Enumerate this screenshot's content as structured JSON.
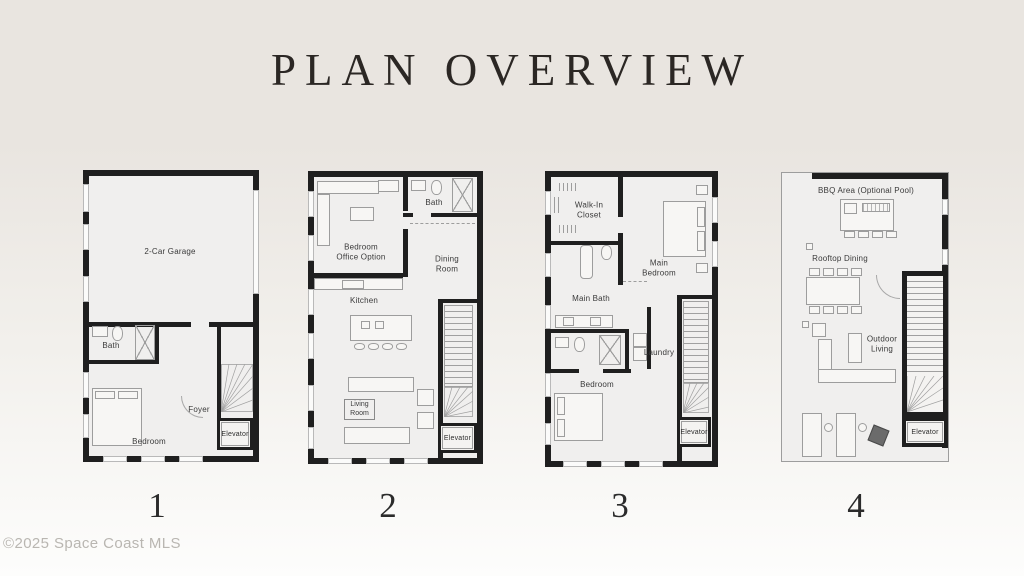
{
  "title": "PLAN OVERVIEW",
  "copyright": "©2025 Space Coast MLS",
  "colors": {
    "background_top": "#e9e5e0",
    "background_bottom": "#fdfdfc",
    "wall": "#1f1f1f",
    "floor": "#f0efee",
    "furniture_line": "#9d9d9d",
    "label_text": "#3a3a3a",
    "title_text": "#2b2724",
    "muted_text": "#b9b6b1"
  },
  "plans": [
    {
      "number": "1",
      "labels": {
        "garage": "2-Car Garage",
        "bath": "Bath",
        "bedroom": "Bedroom",
        "foyer": "Foyer",
        "elevator": "Elevator"
      }
    },
    {
      "number": "2",
      "labels": {
        "bedroom_office": "Bedroom\nOffice Option",
        "bath": "Bath",
        "dining": "Dining\nRoom",
        "kitchen": "Kitchen",
        "living": "Living\nRoom",
        "elevator": "Elevator"
      }
    },
    {
      "number": "3",
      "labels": {
        "closet": "Walk-In\nCloset",
        "main_bedroom": "Main Bedroom",
        "main_bath": "Main Bath",
        "laundry": "Laundry",
        "bedroom": "Bedroom",
        "elevator": "Elevator"
      }
    },
    {
      "number": "4",
      "labels": {
        "bbq": "BBQ Area (Optional Pool)",
        "dining": "Rooftop Dining",
        "living": "Outdoor\nLiving",
        "elevator": "Elevator"
      }
    }
  ]
}
